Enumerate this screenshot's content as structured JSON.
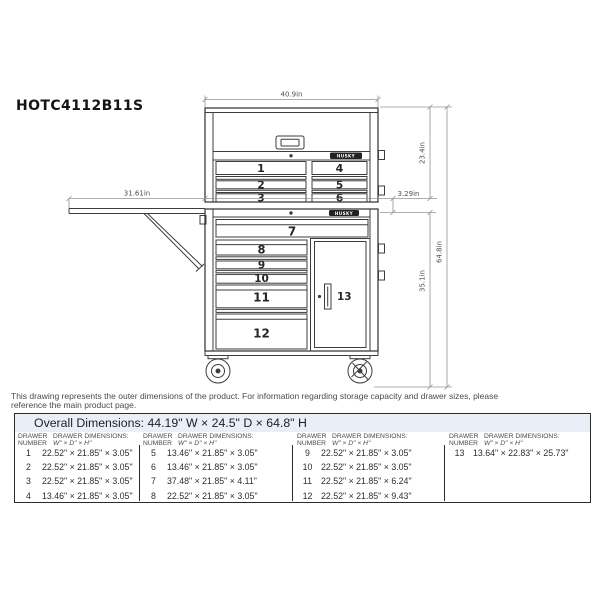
{
  "title": "HOTC4112B11S",
  "drawing": {
    "brand": "HUSKY",
    "dims": {
      "top_width": "40.9in",
      "chest_height": "23.4in",
      "rail_gap": "3.29in",
      "shelf_length": "31.61in",
      "cabinet_height": "35.1in",
      "overall_height": "64.8in"
    },
    "drawer_numbers": [
      "1",
      "2",
      "3",
      "4",
      "5",
      "6",
      "7",
      "8",
      "9",
      "10",
      "11",
      "12",
      "13"
    ]
  },
  "footnote": {
    "line1": "This drawing represents the outer dimensions of the product. For information regarding storage capacity and drawer sizes, please",
    "line2": "reference the main product page."
  },
  "table": {
    "overall_dimensions": "Overall Dimensions: 44.19\" W × 24.5\" D × 64.8\" H",
    "header": {
      "number_l1": "DRAWER",
      "number_l2": "NUMBER",
      "dims_l1": "DRAWER DIMENSIONS:",
      "dims_l2": "W\" × D\" × H\""
    },
    "groups": [
      {
        "rows": [
          {
            "n": "1",
            "d": "22.52\" × 21.85\" × 3.05\""
          },
          {
            "n": "2",
            "d": "22.52\" × 21.85\" × 3.05\""
          },
          {
            "n": "3",
            "d": "22.52\" × 21.85\" × 3.05\""
          },
          {
            "n": "4",
            "d": "13.46\" × 21.85\" × 3.05\""
          }
        ]
      },
      {
        "rows": [
          {
            "n": "5",
            "d": "13.46\" × 21.85\" × 3.05\""
          },
          {
            "n": "6",
            "d": "13.46\" × 21.85\" × 3.05\""
          },
          {
            "n": "7",
            "d": "37.48\" × 21.85\" × 4.11\""
          },
          {
            "n": "8",
            "d": "22.52\" × 21.85\" × 3.05\""
          }
        ]
      },
      {
        "rows": [
          {
            "n": "9",
            "d": "22.52\" × 21.85\" × 3.05\""
          },
          {
            "n": "10",
            "d": "22.52\" × 21.85\" × 3.05\""
          },
          {
            "n": "11",
            "d": "22.52\" × 21.85\" × 6.24\""
          },
          {
            "n": "12",
            "d": "22.52\" × 21.85\" × 9.43\""
          }
        ]
      },
      {
        "rows": [
          {
            "n": "13",
            "d": "13.64\" × 22.83\" × 25.73\""
          }
        ]
      }
    ]
  },
  "colors": {
    "line": "#3d3d3d",
    "dim_line": "#949494",
    "table_border": "#2b2b2b",
    "overall_row_bg": "#e9eff7",
    "logo_bg": "#222222"
  }
}
